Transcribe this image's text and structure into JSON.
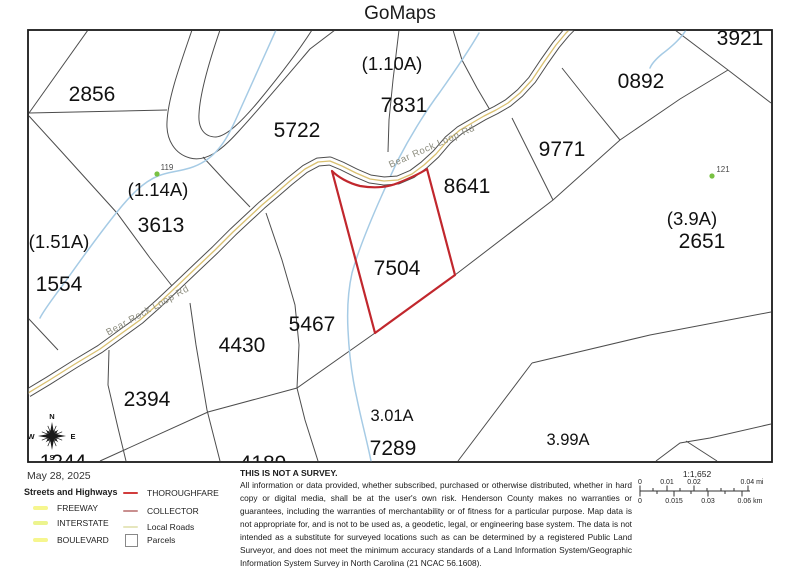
{
  "title": "GoMaps",
  "map": {
    "road_label": "Bear Rock Loop Rd",
    "highlight_parcel": {
      "number": "7504",
      "color": "#c1272d"
    },
    "colors": {
      "parcel_line": "#4d4d4d",
      "stream": "#a6cbe5",
      "road_casing": "#4d4d4d",
      "road_center": "#d9c070",
      "site_dot": "#79c143",
      "border": "#1a1a1a"
    },
    "parcel_numbers": [
      {
        "text": "2856"
      },
      {
        "text": "5722"
      },
      {
        "text": "7831"
      },
      {
        "text": "3921"
      },
      {
        "text": "0892"
      },
      {
        "text": "9771"
      },
      {
        "text": "8641"
      },
      {
        "text": "2651"
      },
      {
        "text": "3613"
      },
      {
        "text": "1554"
      },
      {
        "text": "7504"
      },
      {
        "text": "5467"
      },
      {
        "text": "4430"
      },
      {
        "text": "2394"
      },
      {
        "text": "7289"
      },
      {
        "text": "4189"
      },
      {
        "text": "1244"
      }
    ],
    "acreage_labels": [
      {
        "text": "(1.10A)"
      },
      {
        "text": "(1.14A)"
      },
      {
        "text": "(1.51A)"
      },
      {
        "text": "(3.9A)"
      },
      {
        "text": "3.01A"
      },
      {
        "text": "3.99A"
      }
    ],
    "point_labels": [
      {
        "text": "119"
      },
      {
        "text": "121"
      }
    ],
    "compass": {
      "n": "N",
      "e": "E",
      "s": "S",
      "w": "W"
    }
  },
  "footer": {
    "date": "May 28, 2025",
    "legend": {
      "heading": "Streets and Highways",
      "left_items": [
        {
          "label": "FREEWAY",
          "color": "#f6f68e"
        },
        {
          "label": "INTERSTATE",
          "color": "#ecf48e"
        },
        {
          "label": "BOULEVARD",
          "color": "#f6f68e"
        }
      ],
      "right_items": [
        {
          "label": "THOROUGHFARE",
          "color": "#d13c3c"
        },
        {
          "label": "COLLECTOR",
          "color": "#c98f8f"
        },
        {
          "label": "Local Roads",
          "color": "#e6e6bd"
        },
        {
          "label": "Parcels",
          "color": "#ffffff"
        }
      ]
    },
    "disclaimer": {
      "title": "THIS IS NOT A SURVEY.",
      "body": "All information or data provided, whether subscribed, purchased or otherwise distributed, whether in hard copy or digital media, shall be at the user's own risk.  Henderson County makes no warranties or guarantees, including the warranties of merchantability or of fitness for a particular purpose.  Map data is not appropriate for, and is not to be used as, a geodetic, legal, or engineering base system. The data is not intended as a substitute for surveyed locations such as can be determined by a registered Public Land Surveyor, and does not meet the minimum accuracy standards of a Land Information System/Geographic Information System Survey in North Carolina (21 NCAC 56.1608)."
    },
    "scale": {
      "ratio": "1:1,652",
      "mi": [
        "0",
        "0.01",
        "0.02",
        "0.04 mi"
      ],
      "km": [
        "0",
        "0.015",
        "0.03",
        "0.06 km"
      ]
    }
  }
}
